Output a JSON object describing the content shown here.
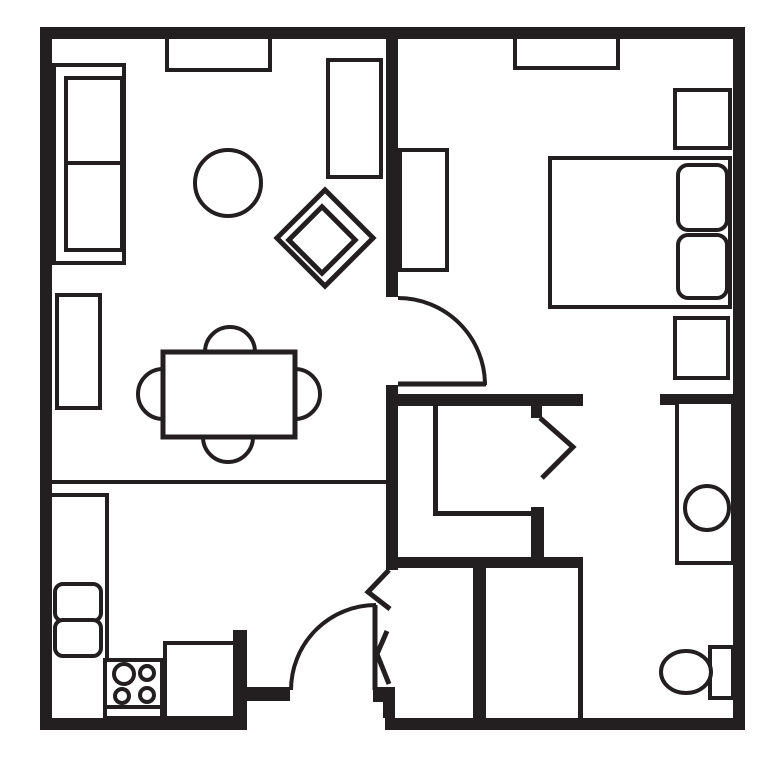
{
  "plan": {
    "width": 779,
    "height": 765,
    "colors": {
      "ink": "#231f20",
      "paper": "#ffffff"
    },
    "elements": [
      {
        "t": "wall",
        "name": "outer-wall-top",
        "x": 40,
        "y": 27,
        "w": 705,
        "h": 12
      },
      {
        "t": "wall",
        "name": "outer-wall-left",
        "x": 40,
        "y": 27,
        "w": 12,
        "h": 703
      },
      {
        "t": "wall",
        "name": "outer-wall-right",
        "x": 733,
        "y": 27,
        "w": 12,
        "h": 703
      },
      {
        "t": "wall",
        "name": "outer-wall-bottom-left",
        "x": 40,
        "y": 718,
        "w": 207,
        "h": 12
      },
      {
        "t": "wall",
        "name": "outer-wall-bottom-right",
        "x": 385,
        "y": 718,
        "w": 360,
        "h": 12
      },
      {
        "t": "wall",
        "name": "bedroom-divider-wall",
        "x": 386,
        "y": 39,
        "w": 12,
        "h": 258
      },
      {
        "t": "wall",
        "name": "hall-left-wall",
        "x": 386,
        "y": 385,
        "w": 12,
        "h": 185
      },
      {
        "t": "wall",
        "name": "hall-top-wall",
        "x": 386,
        "y": 394,
        "w": 197,
        "h": 12
      },
      {
        "t": "wall",
        "name": "bathroom-entry-wall",
        "x": 660,
        "y": 394,
        "w": 73,
        "h": 11
      },
      {
        "t": "wall",
        "name": "hall-closet-door-jamb",
        "x": 531,
        "y": 406,
        "w": 11,
        "h": 12
      },
      {
        "t": "wall",
        "name": "hall-closet-corner-wall",
        "x": 531,
        "y": 507,
        "w": 13,
        "h": 61
      },
      {
        "t": "wall",
        "name": "hall-bottom-wall",
        "x": 386,
        "y": 557,
        "w": 197,
        "h": 11
      },
      {
        "t": "wall",
        "name": "entry-closet-left-wall",
        "x": 473,
        "y": 568,
        "w": 13,
        "h": 150
      },
      {
        "t": "wall",
        "name": "kitchen-entry-wall-vertical",
        "x": 233,
        "y": 630,
        "w": 14,
        "h": 88
      },
      {
        "t": "wall",
        "name": "kitchen-entry-wall-horizontal",
        "x": 233,
        "y": 687,
        "w": 57,
        "h": 14
      },
      {
        "t": "wall",
        "name": "entry-door-jamb",
        "x": 373,
        "y": 687,
        "w": 22,
        "h": 15
      },
      {
        "t": "wall",
        "name": "entry-corner-wall",
        "x": 383,
        "y": 702,
        "w": 12,
        "h": 16
      },
      {
        "t": "wall",
        "name": "kitchen-divider-line",
        "x": 52,
        "y": 480,
        "w": 334,
        "h": 4
      },
      {
        "t": "wall",
        "name": "hall-closet-wall-left",
        "x": 433,
        "y": 406,
        "w": 5,
        "h": 110
      },
      {
        "t": "wall",
        "name": "hall-closet-wall-bottom",
        "x": 433,
        "y": 511,
        "w": 99,
        "h": 5
      },
      {
        "t": "wall",
        "name": "entry-closet-right-wall",
        "x": 578,
        "y": 568,
        "w": 5,
        "h": 150
      },
      {
        "t": "wall",
        "name": "kitchen-counter-edge-top",
        "x": 52,
        "y": 493,
        "w": 57,
        "h": 4
      },
      {
        "t": "wall",
        "name": "kitchen-counter-edge-right",
        "x": 105,
        "y": 493,
        "w": 4,
        "h": 167
      },
      {
        "t": "box",
        "name": "living-room-window",
        "x": 167,
        "y": 37,
        "w": 103,
        "h": 33,
        "sw": 4
      },
      {
        "t": "box",
        "name": "bedroom-window",
        "x": 515,
        "y": 37,
        "w": 103,
        "h": 31,
        "sw": 4
      },
      {
        "t": "box",
        "name": "sofa-outline",
        "x": 54,
        "y": 65,
        "w": 70,
        "h": 198,
        "sw": 4
      },
      {
        "t": "box",
        "name": "sofa-cushions",
        "x": 66,
        "y": 78,
        "w": 56,
        "h": 172,
        "sw": 4
      },
      {
        "t": "wall",
        "name": "sofa-cushion-divider",
        "x": 66,
        "y": 161,
        "w": 56,
        "h": 4
      },
      {
        "t": "circle",
        "name": "round-side-table",
        "cx": 228,
        "cy": 183,
        "r": 33,
        "sw": 4
      },
      {
        "t": "box",
        "name": "media-cabinet",
        "x": 328,
        "y": 60,
        "w": 53,
        "h": 117,
        "sw": 4
      },
      {
        "t": "diamond",
        "name": "accent-chair-outer",
        "cx": 325,
        "cy": 238,
        "s": 68,
        "sw": 5
      },
      {
        "t": "diamond",
        "name": "accent-chair-inner",
        "cx": 322,
        "cy": 240,
        "s": 47,
        "sw": 5
      },
      {
        "t": "box",
        "name": "sideboard",
        "x": 57,
        "y": 295,
        "w": 43,
        "h": 113,
        "sw": 4
      },
      {
        "t": "circle",
        "name": "dining-chair-top",
        "cx": 230,
        "cy": 352,
        "r": 25,
        "sw": 4
      },
      {
        "t": "circle",
        "name": "dining-chair-bottom",
        "cx": 228,
        "cy": 437,
        "r": 25,
        "sw": 4
      },
      {
        "t": "circle",
        "name": "dining-chair-left",
        "cx": 163,
        "cy": 394,
        "r": 25,
        "sw": 4
      },
      {
        "t": "circle",
        "name": "dining-chair-right",
        "cx": 295,
        "cy": 394,
        "r": 25,
        "sw": 4
      },
      {
        "t": "box",
        "name": "dining-table",
        "x": 163,
        "y": 352,
        "w": 132,
        "h": 85,
        "sw": 5
      },
      {
        "t": "rbox",
        "name": "kitchen-sink-upper-basin",
        "x": 55,
        "y": 584,
        "w": 46,
        "h": 37,
        "rx": 8,
        "sw": 4
      },
      {
        "t": "rbox",
        "name": "kitchen-sink-lower-basin",
        "x": 55,
        "y": 620,
        "w": 46,
        "h": 36,
        "rx": 8,
        "sw": 4
      },
      {
        "t": "box",
        "name": "stove",
        "x": 105,
        "y": 660,
        "w": 57,
        "h": 58,
        "sw": 4
      },
      {
        "t": "wall",
        "name": "stove-front-divider",
        "x": 105,
        "y": 705,
        "w": 57,
        "h": 4
      },
      {
        "t": "circle",
        "name": "stove-burner-top-left",
        "cx": 124,
        "cy": 674,
        "r": 10,
        "sw": 4
      },
      {
        "t": "circle",
        "name": "stove-burner-top-right",
        "cx": 147,
        "cy": 673,
        "r": 7,
        "sw": 4
      },
      {
        "t": "circle",
        "name": "stove-burner-bottom-left",
        "cx": 122,
        "cy": 696,
        "r": 7,
        "sw": 4
      },
      {
        "t": "circle",
        "name": "stove-burner-bottom-right",
        "cx": 147,
        "cy": 695,
        "r": 7,
        "sw": 4
      },
      {
        "t": "box",
        "name": "dishwasher-cabinet",
        "x": 165,
        "y": 643,
        "w": 70,
        "h": 75,
        "sw": 4
      },
      {
        "t": "box",
        "name": "bed",
        "x": 550,
        "y": 158,
        "w": 180,
        "h": 149,
        "sw": 4
      },
      {
        "t": "rbox",
        "name": "bed-pillow-upper",
        "x": 678,
        "y": 165,
        "w": 49,
        "h": 65,
        "rx": 10,
        "sw": 4
      },
      {
        "t": "rbox",
        "name": "bed-pillow-lower",
        "x": 678,
        "y": 235,
        "w": 49,
        "h": 63,
        "rx": 10,
        "sw": 4
      },
      {
        "t": "box",
        "name": "nightstand-upper",
        "x": 675,
        "y": 90,
        "w": 55,
        "h": 58,
        "sw": 4
      },
      {
        "t": "box",
        "name": "nightstand-lower",
        "x": 675,
        "y": 318,
        "w": 53,
        "h": 60,
        "sw": 4
      },
      {
        "t": "box",
        "name": "bedroom-dresser",
        "x": 400,
        "y": 150,
        "w": 47,
        "h": 120,
        "sw": 4
      },
      {
        "t": "box",
        "name": "bathroom-vanity",
        "x": 677,
        "y": 402,
        "w": 56,
        "h": 161,
        "sw": 4
      },
      {
        "t": "circle",
        "name": "bathroom-vanity-sink",
        "cx": 707,
        "cy": 508,
        "r": 22,
        "sw": 4
      },
      {
        "t": "box",
        "name": "toilet-tank",
        "x": 710,
        "y": 647,
        "w": 23,
        "h": 51,
        "sw": 4
      },
      {
        "t": "ellipse",
        "name": "toilet-bowl",
        "cx": 686,
        "cy": 672,
        "rx": 25,
        "ry": 21,
        "sw": 4
      },
      {
        "t": "arc",
        "name": "bedroom-door-swing",
        "d": "M 398 298 A 87 87 0 0 1 485 385",
        "sw": 4
      },
      {
        "t": "line",
        "name": "bedroom-door-leaf",
        "x1": 398,
        "y1": 384,
        "x2": 486,
        "y2": 384,
        "sw": 5
      },
      {
        "t": "arc",
        "name": "front-door-swing",
        "d": "M 291 690 A 85 85 0 0 1 376 605",
        "sw": 4
      },
      {
        "t": "line",
        "name": "front-door-leaf",
        "x1": 375,
        "y1": 605,
        "x2": 375,
        "y2": 690,
        "sw": 5
      },
      {
        "t": "poly",
        "name": "hall-closet-door",
        "pts": "540,418 573,447 542,478",
        "sw": 5
      },
      {
        "t": "poly",
        "name": "entry-closet-door-upper",
        "pts": "389,570 368,592 390,609",
        "sw": 5
      },
      {
        "t": "poly",
        "name": "entry-closet-door-lower",
        "pts": "387,631 377,654 389,684",
        "sw": 5
      }
    ]
  }
}
